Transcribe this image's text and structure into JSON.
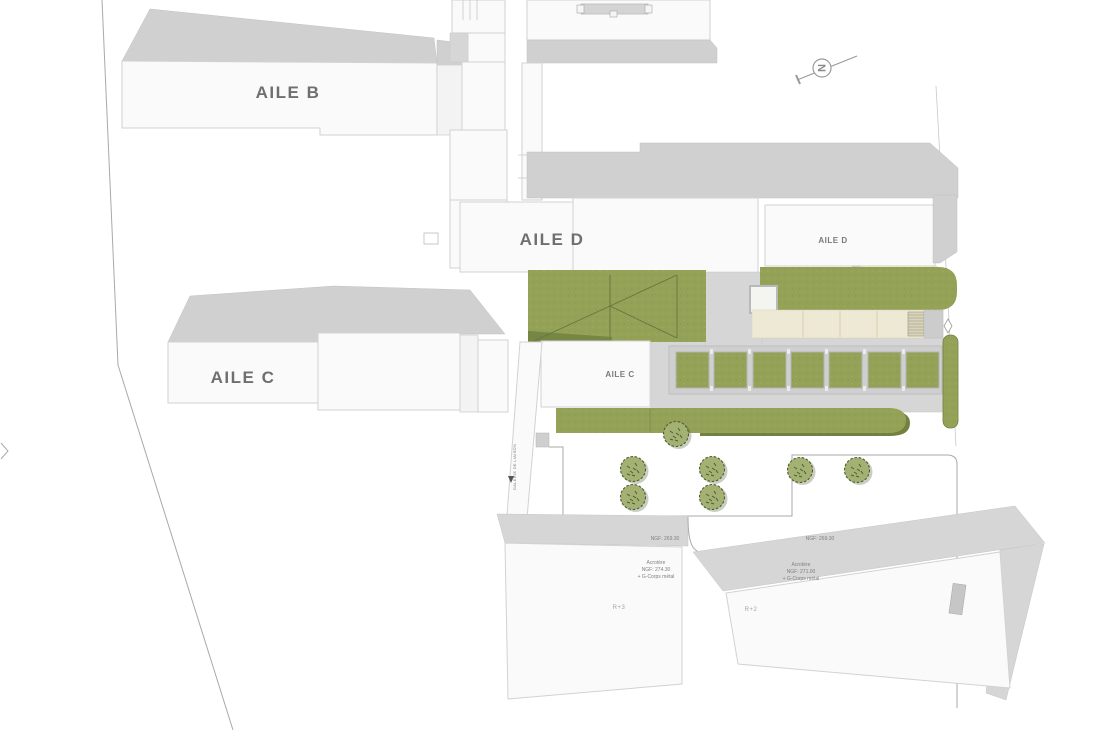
{
  "plan": {
    "buildings": {
      "aile_b": "AILE B",
      "aile_c_main": "AILE C",
      "aile_c_small": "AILE C",
      "aile_d_main": "AILE D",
      "aile_d_small": "AILE D",
      "r3": "R+3",
      "r2": "R+2"
    },
    "annotations": {
      "ngf_left": "NGF: 269.30",
      "ngf_right": "NGF: 269.30",
      "acrotere_left": {
        "l1": "Acrotère",
        "l2": "NGF: 274.30",
        "l3": "+ G-Corps métal"
      },
      "acrotere_right": {
        "l1": "Acrotère",
        "l2": "NGF: 271.00",
        "l3": "+ G-Corps métal"
      },
      "galerie": "GALERIE DE LIAISON"
    },
    "north_label": "N",
    "colors": {
      "grass_green": "#94a257",
      "grass_dark": "#71813f",
      "roof_gray": "#d0d0d0",
      "walkway_gray": "#d6d6d6",
      "building_white": "#fafafa",
      "terrace_beige": "#eee9d4",
      "tree_green": "#a3b272",
      "outline_gray": "#b0b0b0"
    }
  }
}
